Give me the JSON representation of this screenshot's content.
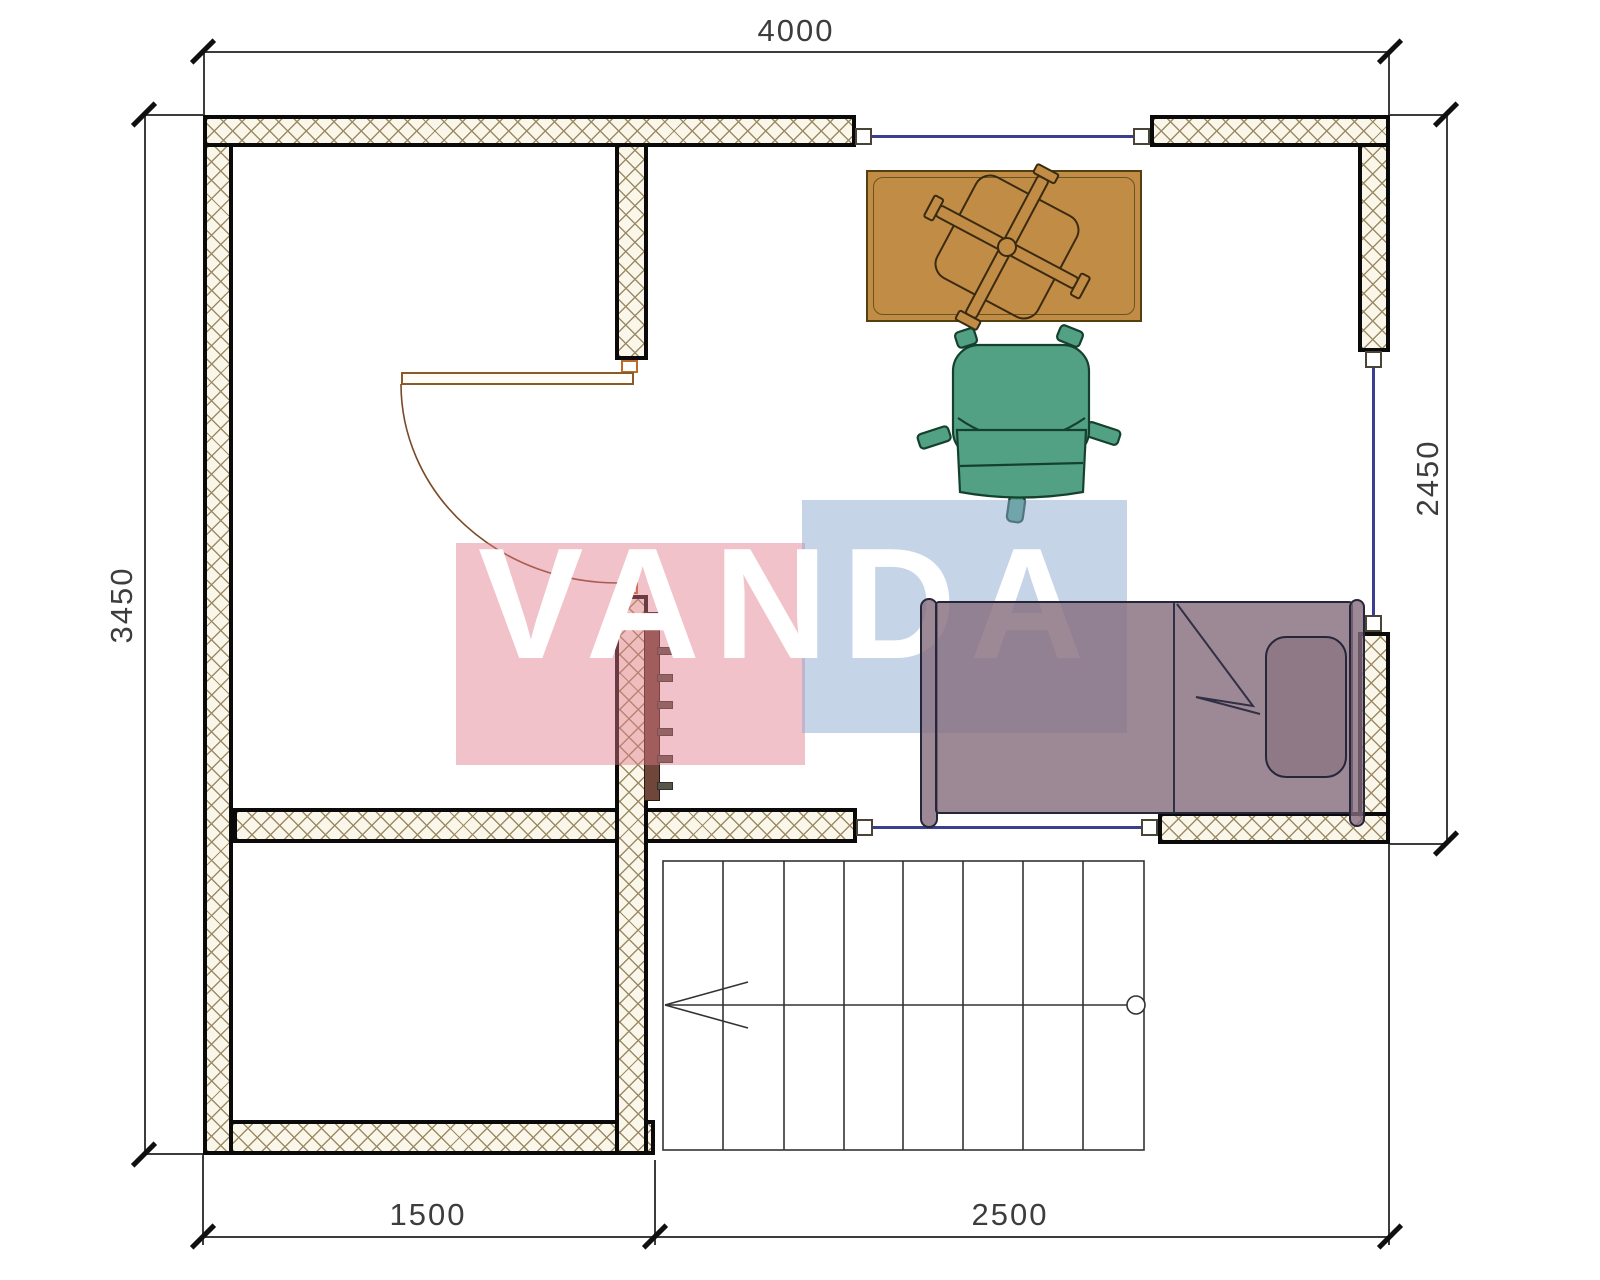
{
  "title": "floor-plan",
  "watermark": {
    "text": "VANDA",
    "pink_hex": "#e17887",
    "blue_hex": "#8da9d1"
  },
  "dimensions": {
    "top": "4000",
    "left": "3450",
    "right": "2450",
    "bottom_left": "1500",
    "bottom_right": "2500"
  },
  "colors": {
    "wall_hatch": "#9c8c66",
    "wall_fill": "#fbf6ea",
    "window_line": "#3a3f8f",
    "desk": "#c18c45",
    "chair": "#53a184",
    "bed": "#9a8290",
    "radiator": "#6e463a"
  }
}
